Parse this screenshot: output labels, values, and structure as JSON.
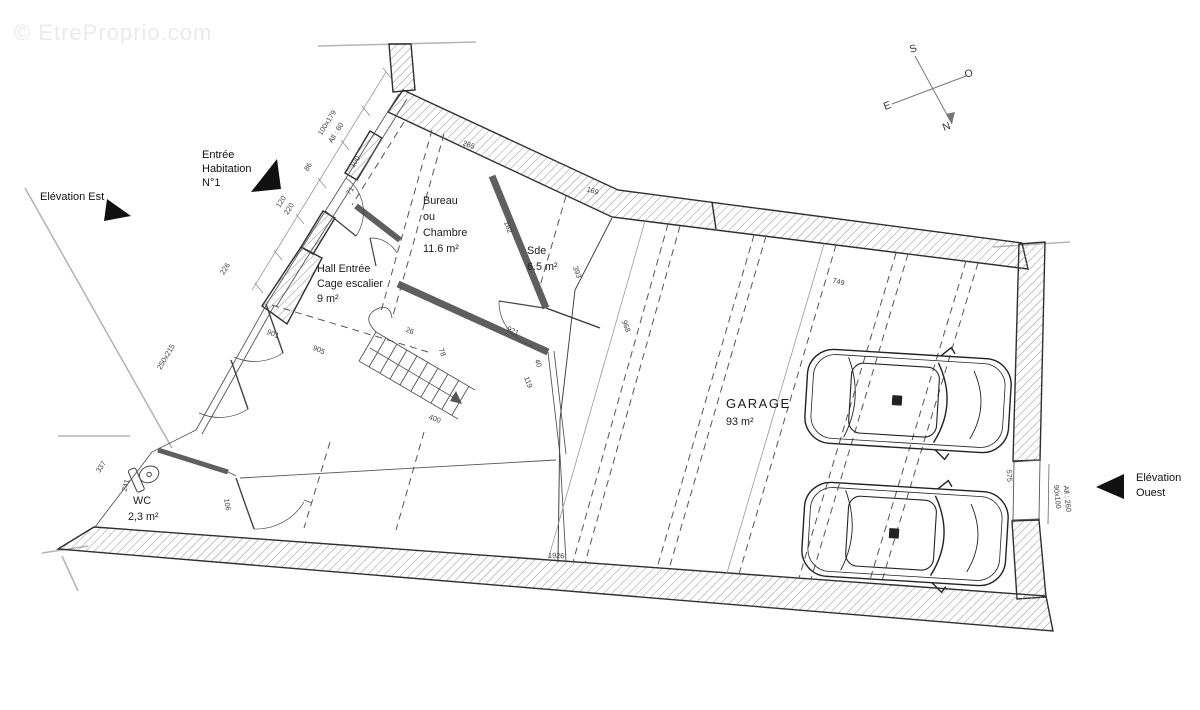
{
  "watermark": "© EtreProprio.com",
  "annotations": {
    "entree_1": "Entrée",
    "entree_2": "Habitation",
    "entree_3": "N°1",
    "elevation_est": "Elévation Est",
    "elevation_ouest_1": "Elévation",
    "elevation_ouest_2": "Ouest"
  },
  "compass": {
    "s": "S",
    "o": "O",
    "e": "E",
    "n": "N"
  },
  "rooms": {
    "bureau": {
      "l1": "Bureau",
      "l2": "ou",
      "l3": "Chambre",
      "l4": "11.6 m²"
    },
    "sde": {
      "l1": "Sde",
      "l2": "6.5 m²"
    },
    "hall": {
      "l1": "Hall Entrée",
      "l2": "Cage escalier",
      "l3": "9 m²"
    },
    "wc": {
      "l1": "WC",
      "l2": "2,3 m²"
    },
    "garage": {
      "l1": "GARAGE",
      "l2": "93 m²"
    }
  },
  "colors": {
    "line": "#2f2f2f",
    "hatch": "#9a9a9a",
    "partition": "#5f5f5f",
    "construction": "#b5b5b5"
  },
  "dimensions": [
    {
      "t": "100x179",
      "x": 329,
      "y": 124,
      "r": -58
    },
    {
      "t": "All : 60",
      "x": 338,
      "y": 134,
      "r": -58
    },
    {
      "t": "86",
      "x": 310,
      "y": 168,
      "r": -58
    },
    {
      "t": "100",
      "x": 357,
      "y": 163,
      "r": -58
    },
    {
      "t": "71",
      "x": 352,
      "y": 192,
      "r": -58
    },
    {
      "t": "120",
      "x": 283,
      "y": 203,
      "r": -58
    },
    {
      "t": "220",
      "x": 291,
      "y": 210,
      "r": -58
    },
    {
      "t": "226",
      "x": 227,
      "y": 270,
      "r": -58
    },
    {
      "t": "250x215",
      "x": 168,
      "y": 358,
      "r": -60
    },
    {
      "t": "337",
      "x": 103,
      "y": 468,
      "r": -58
    },
    {
      "t": "241",
      "x": 128,
      "y": 486,
      "r": -75
    },
    {
      "t": "106",
      "x": 225,
      "y": 505,
      "r": 80
    },
    {
      "t": "901",
      "x": 272,
      "y": 336,
      "r": 24
    },
    {
      "t": "905",
      "x": 318,
      "y": 352,
      "r": 24
    },
    {
      "t": "400",
      "x": 434,
      "y": 421,
      "r": 20
    },
    {
      "t": "265",
      "x": 468,
      "y": 147,
      "r": 19
    },
    {
      "t": "169",
      "x": 592,
      "y": 193,
      "r": 17
    },
    {
      "t": "393",
      "x": 575,
      "y": 273,
      "r": 70
    },
    {
      "t": "968",
      "x": 624,
      "y": 327,
      "r": 70
    },
    {
      "t": "162",
      "x": 506,
      "y": 228,
      "r": 70
    },
    {
      "t": "921",
      "x": 512,
      "y": 333,
      "r": 25
    },
    {
      "t": "119",
      "x": 526,
      "y": 383,
      "r": 70
    },
    {
      "t": "40",
      "x": 536,
      "y": 364,
      "r": 70
    },
    {
      "t": "26",
      "x": 409,
      "y": 333,
      "r": 22
    },
    {
      "t": "78",
      "x": 440,
      "y": 353,
      "r": 70
    },
    {
      "t": "749",
      "x": 838,
      "y": 284,
      "r": 13
    },
    {
      "t": "1926",
      "x": 556,
      "y": 558,
      "r": 3
    },
    {
      "t": "575",
      "x": 1007,
      "y": 476,
      "r": 85
    },
    {
      "t": "90x100",
      "x": 1055,
      "y": 497,
      "r": 84
    },
    {
      "t": "All : 260",
      "x": 1065,
      "y": 499,
      "r": 84
    }
  ]
}
